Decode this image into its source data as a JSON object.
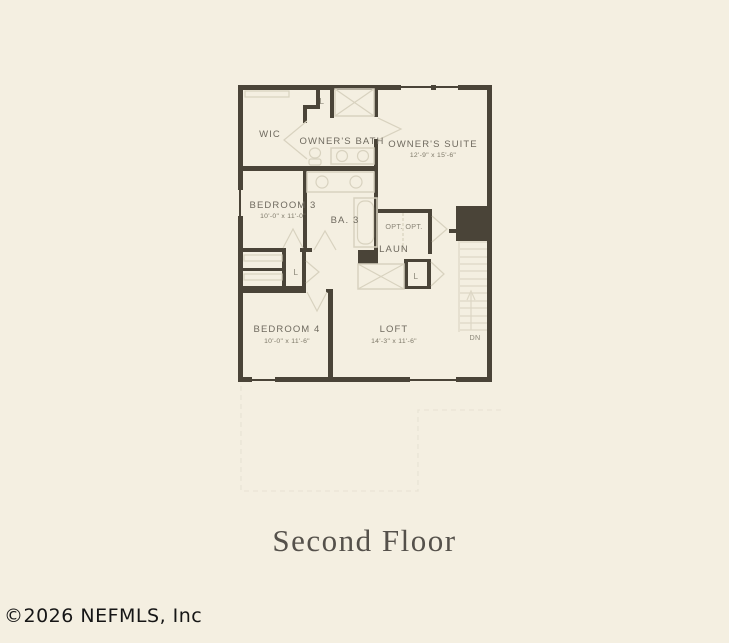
{
  "page": {
    "title": "Second Floor",
    "watermark": "©2026 NEFMLS, Inc"
  },
  "floor_plan": {
    "rooms": [
      {
        "id": "wic",
        "label": "WIC",
        "dims": ""
      },
      {
        "id": "owners-bath",
        "label": "OWNER'S BATH",
        "dims": ""
      },
      {
        "id": "owners-suite",
        "label": "OWNER'S SUITE",
        "dims": "12'-9\" x 15'-6\""
      },
      {
        "id": "bedroom-3",
        "label": "BEDROOM 3",
        "dims": "10'-0\" x 11'-0\""
      },
      {
        "id": "bath-3",
        "label": "BA. 3",
        "dims": ""
      },
      {
        "id": "laundry",
        "label": "LAUN",
        "dims": ""
      },
      {
        "id": "bedroom-4",
        "label": "BEDROOM 4",
        "dims": "10'-0\" x 11'-6\""
      },
      {
        "id": "loft",
        "label": "LOFT",
        "dims": "14'-3\" x 11'-6\""
      }
    ],
    "closets": {
      "linen_labels": [
        "L",
        "L",
        "L"
      ]
    },
    "optional_labels": [
      "OPT.",
      "OPT."
    ],
    "stairs": {
      "direction_label": "DN"
    }
  },
  "colors": {
    "background": "#f4efe1",
    "wall": "#4a4438",
    "fixture_line": "#d8d2bf",
    "faint_outline": "#e9e4d5",
    "room_label": "#6f6a5f",
    "dimension_label": "#7d7868",
    "title_text": "#55514b",
    "watermark_text": "#161616"
  }
}
